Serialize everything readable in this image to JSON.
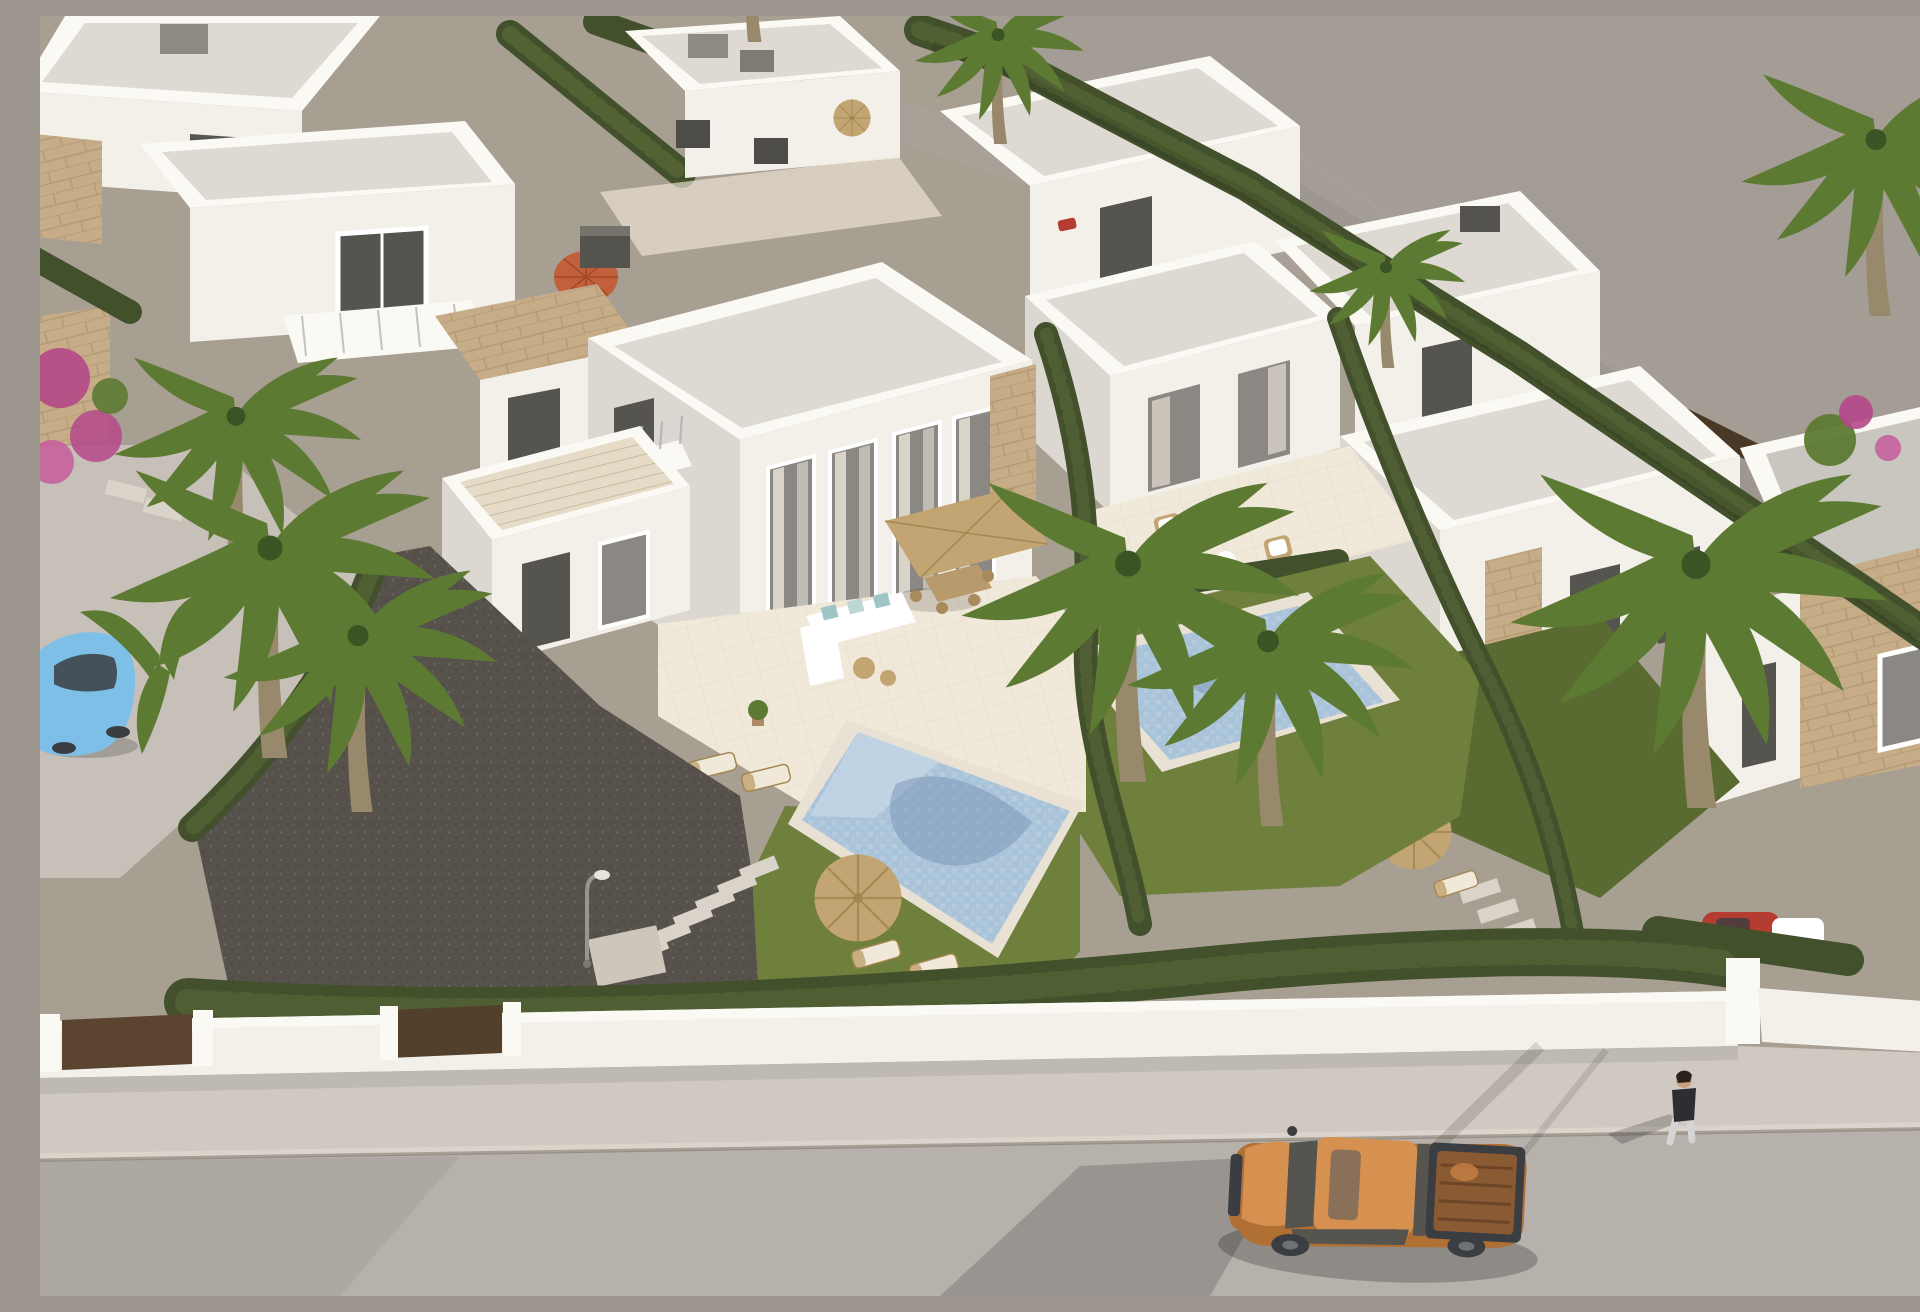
{
  "scene": {
    "type": "aerial-3d-architectural-render",
    "setting": "Aerial 3D render of a modern residential development of white flat-roofed villas with private pools, gardens, palm trees and hedges beside a street",
    "lighting": "warm late-afternoon sun from the upper right, long shadows to the lower left",
    "elements": [
      "white flat-roof villas with parapets",
      "central two-storey twin villa with glass facade and curtains",
      "stone-clad wall accents",
      "two mosaic swimming pools",
      "lawned gardens",
      "cypress hedges between plots",
      "tall fan palm trees",
      "pink bougainvillea",
      "dark gravel driveway with stepping stones",
      "street lamp",
      "straw parasols with sun loungers",
      "square tan patio parasol over dining set",
      "white L-shaped outdoor sofa with teal cushions",
      "red patio umbrella",
      "roof-terrace stairs",
      "white perimeter wall with brown gates",
      "sidewalk and asphalt street",
      "orange pickup truck with open bed",
      "light blue car parked on driveway",
      "red car behind hedge",
      "small gray car on back road",
      "pedestrian walking on the street",
      "vacant flat gray land at upper right"
    ]
  },
  "palette": {
    "land": "#9e978f",
    "landLight": "#aaa39b",
    "devGround": "#a89f93",
    "street": "#b7b1ab",
    "sidewalk": "#cfc9c1",
    "wallWhite": "#f3f0ea",
    "wallBright": "#fbf9f4",
    "wallShade": "#dcd7d0",
    "wallDark": "#c7c2ba",
    "roofSlab": "#dedad3",
    "roofLight": "#eae7e1",
    "roofGray": "#c9c5bf",
    "stone": "#c6ac87",
    "stoneDark": "#a78e6b",
    "glass": "#8b8883",
    "glassDark": "#56544f",
    "glassRail": "#aeb7ba",
    "curtain": "#d9d3c8",
    "hedge": "#42502c",
    "hedgeLight": "#5d6e39",
    "lawn": "#6f7f3c",
    "lawnShade": "#596b30",
    "tile": "#e6dbc6",
    "tileL": "#f0e8d8",
    "tileLight": "#f0e8d8",
    "coping": "#e9e2d4",
    "poolWater": "#a9c3d9",
    "poolLight": "#c6d7e5",
    "poolShadow": "#7b97b8",
    "parasol": "#c2a572",
    "parasolDark": "#a2854f",
    "umbrellaRed": "#c2603c",
    "truckOrange": "#d69050",
    "truckOrangeDark": "#b06f33",
    "truckBed": "#8a5a33",
    "vehicleDark": "#3a3d42",
    "carBlue": "#7dbfe6",
    "carRed": "#b43c30",
    "trunk": "#99896c",
    "palm": "#5d7a33",
    "palmDark": "#3c5423",
    "gravel": "#56514b",
    "gravelDot": "#68635c",
    "gateBrown": "#5b4530",
    "skin": "#c9a07f",
    "shirtDark": "#2e2d33",
    "pants": "#d6d4d3",
    "bougainvillea": "#b5488a",
    "white": "#ffffff"
  }
}
